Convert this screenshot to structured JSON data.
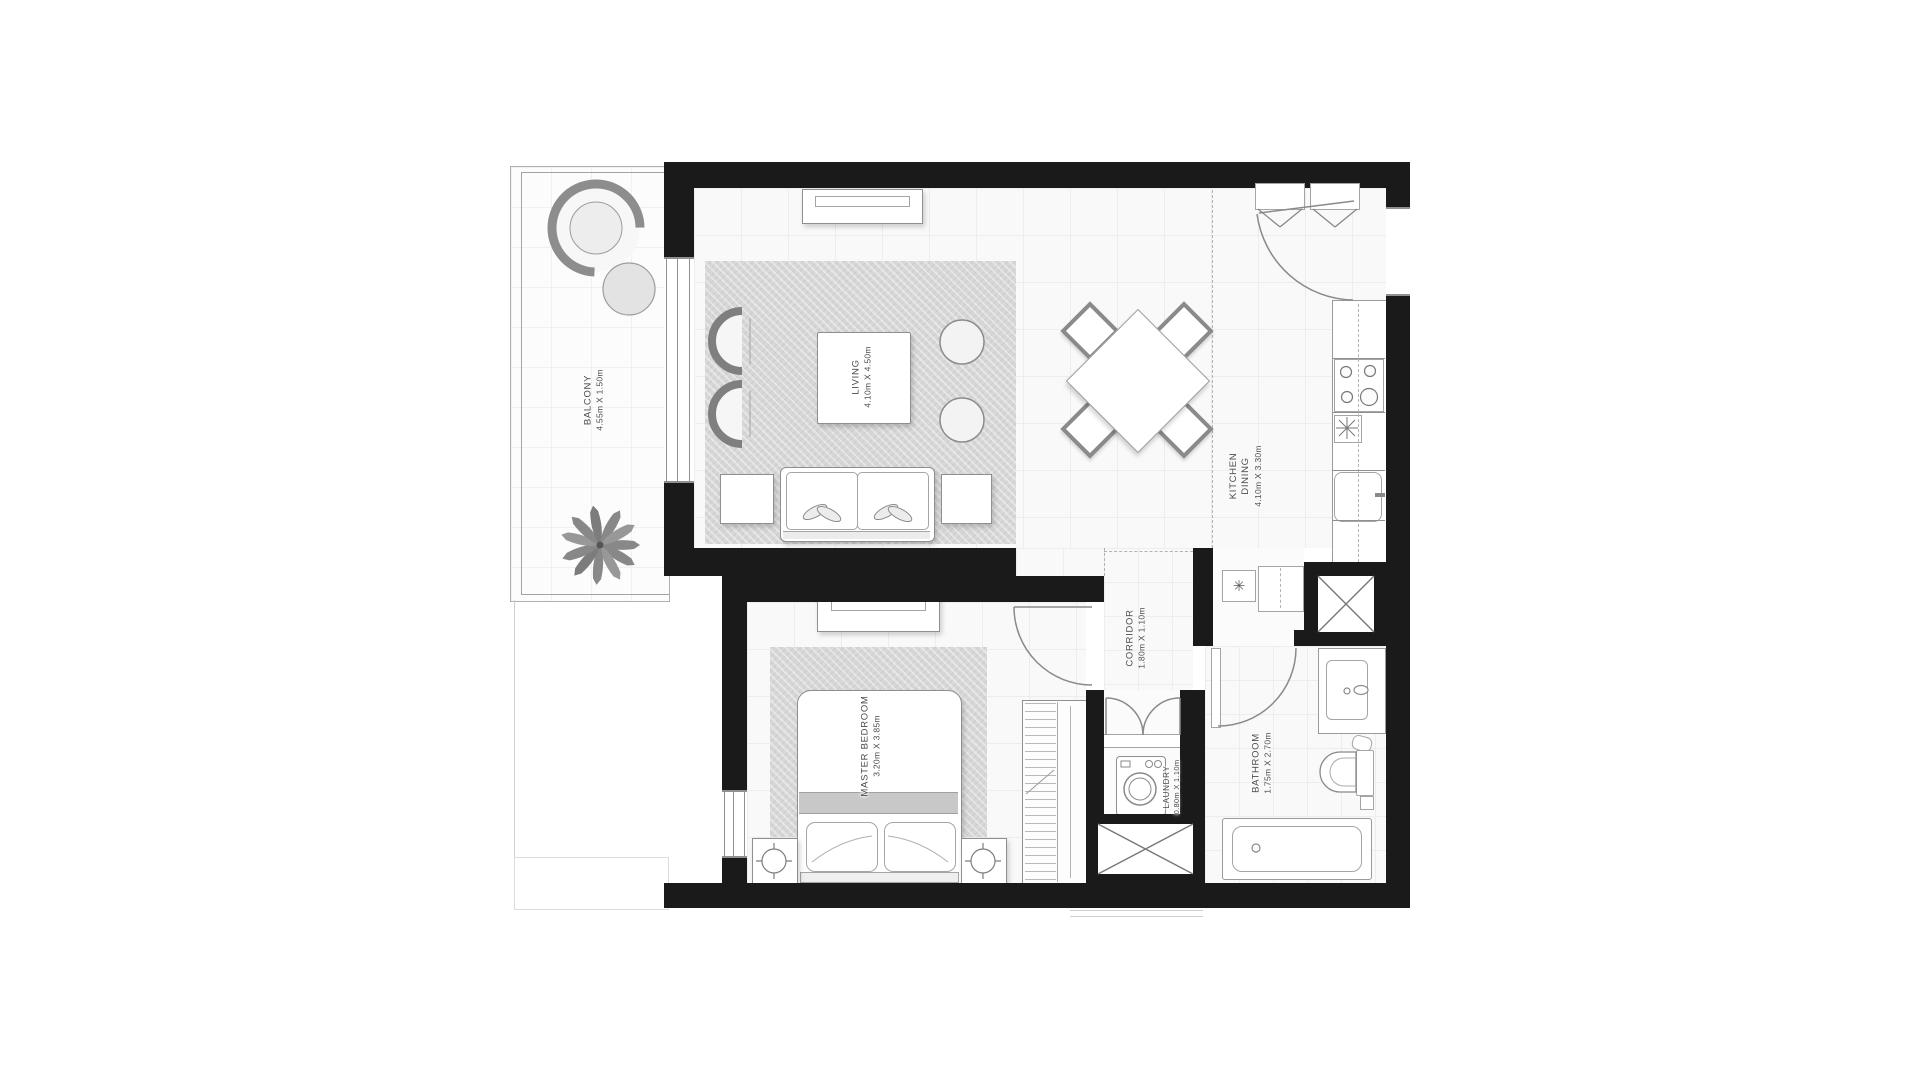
{
  "plan": {
    "rooms": {
      "balcony": {
        "line1": "BALCONY",
        "dims": "4.55m X 1.50m"
      },
      "living": {
        "line1": "LIVING",
        "dims": "4.10m X 4.50m"
      },
      "kitchen": {
        "line1": "KITCHEN",
        "line2": "DINING",
        "dims": "4.10m X 3.30m"
      },
      "corridor": {
        "line1": "CORRIDOR",
        "dims": "1.80m X 1.10m"
      },
      "master": {
        "line1": "MASTER BEDROOM",
        "dims": "3.20m X 3.85m"
      },
      "laundry": {
        "line1": "LAUNDRY",
        "dims": "0.80m X 1.10m"
      },
      "bathroom": {
        "line1": "BATHROOM",
        "dims": "1.75m X 2.70m"
      }
    },
    "symbols": {
      "utility": "✳"
    },
    "colors": {
      "wall": "#1a1a1a",
      "floor": "#f9f9f9",
      "grid": "#ededed",
      "carpet": "#d7d7d7",
      "line": "#8a8a8a",
      "text": "#4a4a4a"
    }
  }
}
